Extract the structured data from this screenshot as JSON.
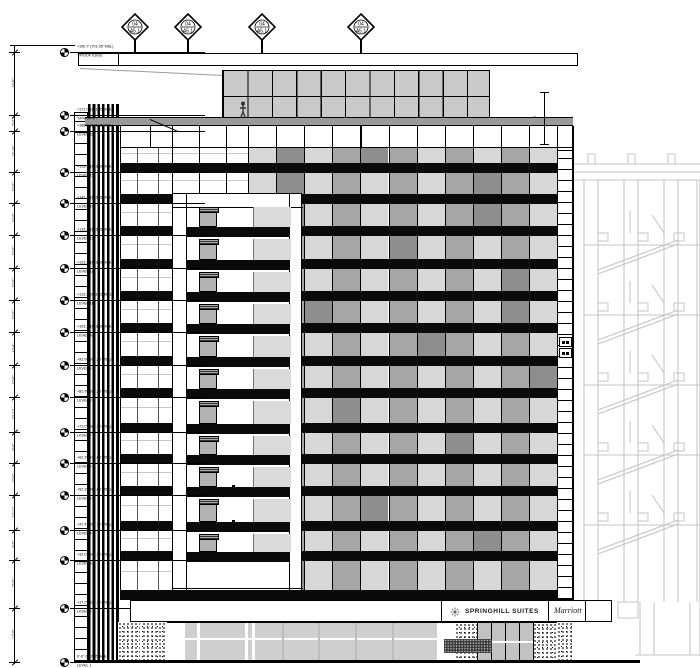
{
  "drawing": {
    "title": "Hotel Building Elevation",
    "type": "architectural-elevation"
  },
  "levels": [
    {
      "name": "T/ROOF EDGE",
      "elevation": "+190.7' (701.05' MSL)",
      "y": 52
    },
    {
      "name": "T/PARAPET",
      "elevation": "+171.0' (681.35' MSL)",
      "y": 115
    },
    {
      "name": "LEVEL 16",
      "elevation": "+166.0' (676.35' MSL)",
      "y": 131
    },
    {
      "name": "LEVEL 15",
      "elevation": "+153.2' (663.55' MSL)",
      "y": 172
    },
    {
      "name": "LEVEL 14",
      "elevation": "+143.2' (653.55' MSL)",
      "y": 203
    },
    {
      "name": "LEVEL 13",
      "elevation": "+133.2' (643.55' MSL)",
      "y": 235
    },
    {
      "name": "LEVEL 12",
      "elevation": "+123.2' (633.55' MSL)",
      "y": 268
    },
    {
      "name": "LEVEL 11",
      "elevation": "+113.2' (623.55' MSL)",
      "y": 300
    },
    {
      "name": "LEVEL 10",
      "elevation": "+103.2' (613.55' MSL)",
      "y": 332
    },
    {
      "name": "LEVEL 9",
      "elevation": "+92.9' (603.25' MSL)",
      "y": 365
    },
    {
      "name": "LEVEL 8",
      "elevation": "+82.9' (593.25' MSL)",
      "y": 397
    },
    {
      "name": "LEVEL 7",
      "elevation": "+72.0' (582.35' MSL)",
      "y": 432
    },
    {
      "name": "LEVEL 6",
      "elevation": "+62.3' (572.65' MSL)",
      "y": 463
    },
    {
      "name": "LEVEL 5",
      "elevation": "+52.3' (562.65' MSL)",
      "y": 495
    },
    {
      "name": "LEVEL 4",
      "elevation": "+41.4' (551.75' MSL)",
      "y": 530
    },
    {
      "name": "LEVEL 3",
      "elevation": "+32.0' (542.35' MSL)",
      "y": 560
    },
    {
      "name": "LEVEL 2",
      "elevation": "+17.0' (527.35' MSL)",
      "y": 608
    },
    {
      "name": "LEVEL 1",
      "elevation": "0'-0\" (510.35' MSL)",
      "y": 662
    }
  ],
  "dimensions": {
    "segments": [
      "19'-8\"",
      "5'-0\"",
      "12'-10\"",
      "10'-0\"",
      "10'-0\"",
      "10'-0\"",
      "10'-0\"",
      "10'-0\"",
      "10'-4\"",
      "10'-0\"",
      "10'-11\"",
      "9'-8\"",
      "10'-0\"",
      "10'-11\"",
      "9'-5\"",
      "15'-0\"",
      "17'-0\""
    ],
    "parapet_dim": "9'"
  },
  "roof_markers": [
    {
      "top": "04",
      "bottom": "A5.1",
      "x": 135
    },
    {
      "top": "04",
      "bottom": "A5.1",
      "x": 188
    },
    {
      "top": "04",
      "bottom": "A5.1",
      "x": 262
    },
    {
      "top": "04",
      "bottom": "A5.1",
      "x": 361
    }
  ],
  "signage": {
    "logo": "springhill-sun-icon",
    "name": "SPRINGHILL SUITES",
    "brand": "Marriott"
  },
  "colors": {
    "spandrel": "#0a0a0a",
    "glass_light": "#d7d7d7",
    "glass_mid": "#a6a6a6",
    "glass_dark": "#8e8e8e",
    "penthouse": "#c9c9c9",
    "band_gray": "#9a9a9a",
    "garage_line": "#c5c5c5",
    "storefront_glass": "#cfcfcf",
    "door_glass": "#c2c2c2"
  },
  "facade": {
    "floor_rows": 14,
    "window_bays": 11,
    "dark_cells": [
      [
        0,
        1
      ],
      [
        1,
        1
      ],
      [
        2,
        8
      ],
      [
        5,
        9
      ]
    ]
  }
}
